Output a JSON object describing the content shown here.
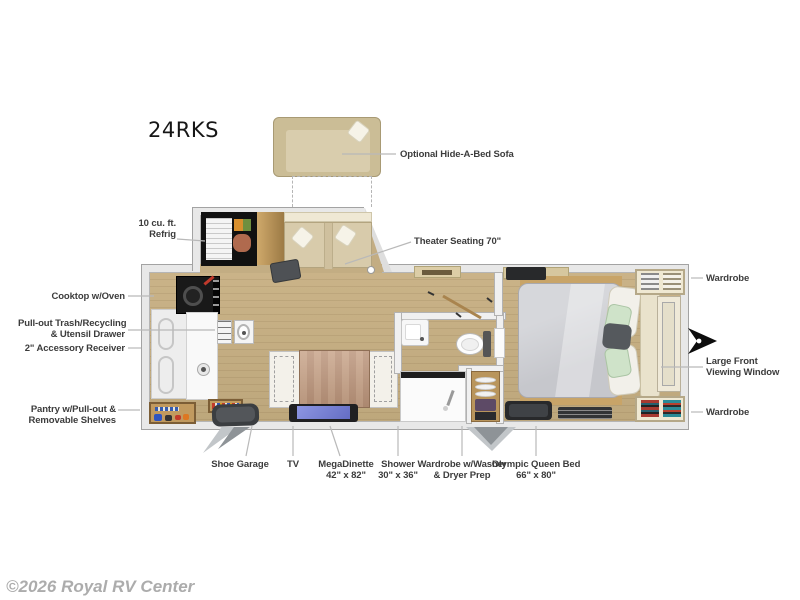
{
  "title": "24RKS",
  "watermark": "©2026 Royal RV Center",
  "colors": {
    "floor": "#c3ad83",
    "wall": "#e8e8e8",
    "label_text": "#3c3c3c",
    "leader_line": "#b9b9b9",
    "sofa_tan": "#cbbd96",
    "theater_seat_tan": "#d8cbab",
    "tv_screen": "#7d86d8",
    "mattress_gray": "#ced0d4",
    "pillow_green": "#cfe3c9",
    "wood": "#c19a5f",
    "hitch_black": "#0d0d0d",
    "watermark_gray": "#acacac"
  },
  "icons": {
    "hitch": "hitch-arrow-icon"
  },
  "callouts": {
    "optional_sofa": {
      "text": "Optional Hide-A-Bed Sofa"
    },
    "refrig": {
      "line1": "10 cu. ft.",
      "line2": "Refrig"
    },
    "theater": {
      "text": "Theater Seating 70\""
    },
    "cooktop": {
      "text": "Cooktop w/Oven"
    },
    "trash": {
      "line1": "Pull-out Trash/Recycling",
      "line2": "& Utensil Drawer"
    },
    "receiver": {
      "text": "2\" Accessory Receiver"
    },
    "pantry": {
      "line1": "Pantry w/Pull-out &",
      "line2": "Removable Shelves"
    },
    "wardrobe_top": {
      "text": "Wardrobe"
    },
    "front_window": {
      "line1": "Large Front",
      "line2": "Viewing Window"
    },
    "wardrobe_bottom": {
      "text": "Wardrobe"
    },
    "shoe_garage": {
      "text": "Shoe Garage"
    },
    "tv": {
      "text": "TV"
    },
    "dinette": {
      "line1": "MegaDinette",
      "line2": "42\" x 82\""
    },
    "shower": {
      "line1": "Shower",
      "line2": "30\" x 36\""
    },
    "washer": {
      "line1": "Wardrobe w/Washer",
      "line2": "& Dryer Prep"
    },
    "queen_bed": {
      "line1": "Olympic Queen Bed",
      "line2": "66\" x 80\""
    }
  }
}
